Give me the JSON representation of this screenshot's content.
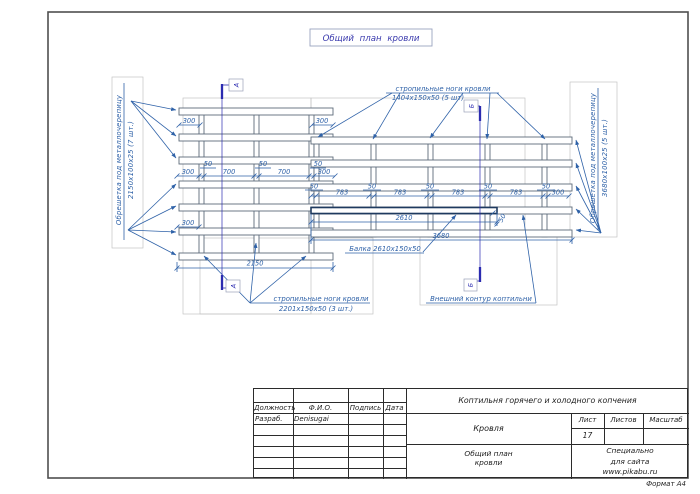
{
  "sheet": {
    "drawing_title": "Общий план кровли",
    "format_label": "Формат А4"
  },
  "annotations": {
    "lath_left_line1": "Обрешетка под металлочерепицу",
    "lath_left_line2": "2150х100х25 (7 шт.)",
    "lath_right_line1": "Обрешетка под металлочерепицу",
    "lath_right_line2": "3680х100х25 (5 шт.)",
    "rafters_top_line1": "стропильные ноги кровли",
    "rafters_top_line2": "1404х150х50 (5 шт)",
    "rafters_bottom_line1": "стропильные ноги кровли",
    "rafters_bottom_line2": "2201х150х50 (3 шт.)",
    "beam_label": "Балка 2610х150х50",
    "contour_label": "Внешний контур коптильни"
  },
  "dimensions": {
    "d300": "300",
    "d700": "700",
    "d50": "50",
    "d783": "783",
    "d2150": "2150",
    "d2610": "2610",
    "d3680": "3680"
  },
  "section_marks": {
    "a": "А",
    "b": "Б"
  },
  "title_block": {
    "project_title": "Коптильня горячего и холодного копчения",
    "part_title": "Кровля",
    "sheet_title_line1": "Общий план",
    "sheet_title_line2": "кровли",
    "col_position": "Должность",
    "col_name": "Ф.И.О.",
    "col_signature": "Подпись",
    "col_date": "Дата",
    "row_role": "Разраб.",
    "row_name": "Denisugai",
    "col_sheet": "Лист",
    "col_sheets": "Листов",
    "col_scale": "Масштаб",
    "sheet_number": "17",
    "credit_line1": "Специально",
    "credit_line2": "для сайта",
    "credit_line3": "www.pikabu.ru"
  },
  "colors": {
    "drawing_blue": "#2f62a8",
    "section_indigo": "#2b2bb0",
    "wood_outline": "#5d6b7a",
    "frame_gray": "#4f4f4f",
    "aux_gray": "#bcbcbc",
    "title_blue": "#3c3cae"
  }
}
